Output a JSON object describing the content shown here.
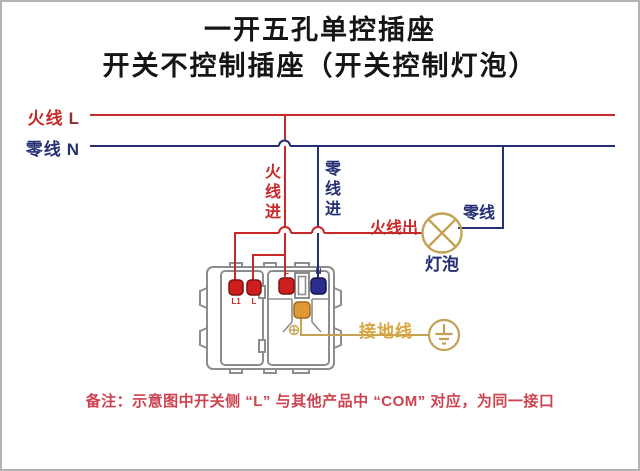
{
  "colors": {
    "red": "#c62a2a",
    "dark_red": "#8f2f2f",
    "navy": "#252f73",
    "tan": "#c3a254",
    "tan_text": "#d9a53e",
    "note_red": "#cb4350",
    "title_black": "#151515",
    "device_gray": "#8d8d8d",
    "terminal_red": "#ce1e1e",
    "terminal_blue": "#2b2d8e",
    "terminal_orange": "#e09a33"
  },
  "title": {
    "line1": "一开五孔单控插座",
    "line2": "开关不控制插座（开关控制灯泡）"
  },
  "supply": {
    "live_name": "火线",
    "live_letter": "L",
    "neutral_name": "零线",
    "neutral_letter": "N"
  },
  "labels": {
    "live_in": "火线进",
    "neutral_in": "零线进",
    "live_out": "火线出",
    "lamp_neutral": "零线",
    "lamp": "灯泡",
    "ground": "接地线"
  },
  "device": {
    "switch_terminals": [
      {
        "label": "L1"
      },
      {
        "label": "L"
      }
    ],
    "socket_terminals": [
      {
        "label": "L"
      },
      {
        "label": "N"
      }
    ]
  },
  "note": "备注：示意图中开关侧 “L” 与其他产品中 “COM” 对应，为同一接口"
}
